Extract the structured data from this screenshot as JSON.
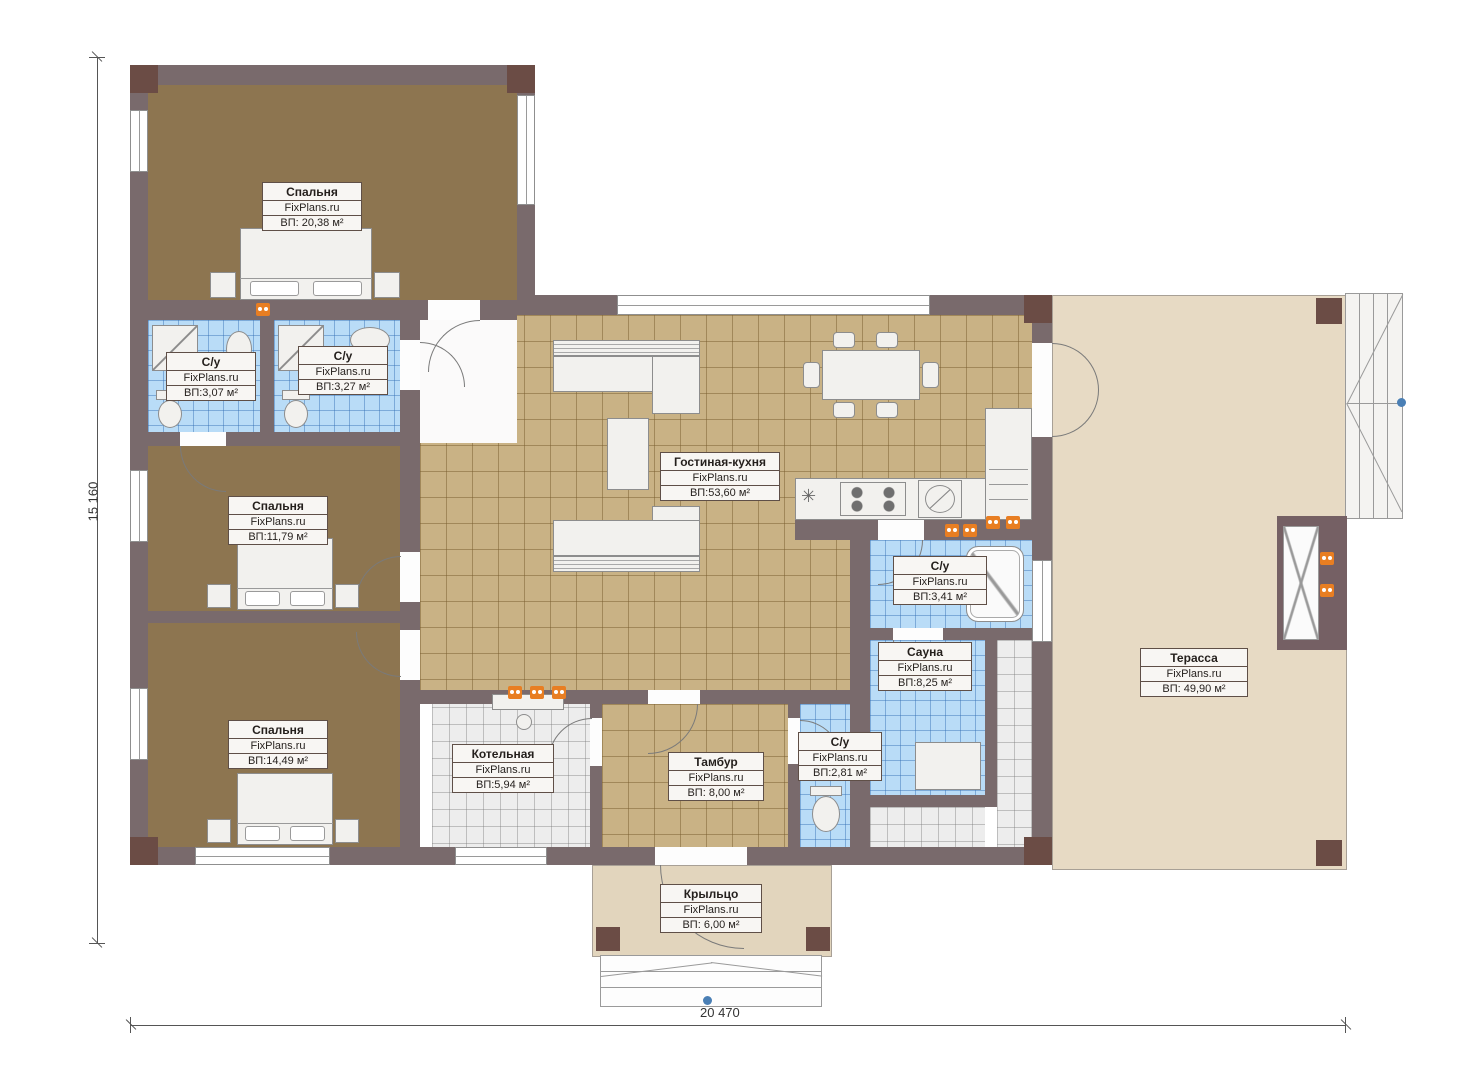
{
  "plan": {
    "height_label": "15 160",
    "width_label": "20 470"
  },
  "rooms": {
    "bedroom_top": {
      "name": "Спальня",
      "brand": "FixPlans.ru",
      "area": "ВП: 20,38 м²"
    },
    "bath_1": {
      "name": "С/у",
      "brand": "FixPlans.ru",
      "area": "ВП:3,07 м²"
    },
    "bath_2": {
      "name": "С/у",
      "brand": "FixPlans.ru",
      "area": "ВП:3,27 м²"
    },
    "bedroom_mid": {
      "name": "Спальня",
      "brand": "FixPlans.ru",
      "area": "ВП:11,79 м²"
    },
    "bedroom_low": {
      "name": "Спальня",
      "brand": "FixPlans.ru",
      "area": "ВП:14,49 м²"
    },
    "living": {
      "name": "Гостиная-кухня",
      "brand": "FixPlans.ru",
      "area": "ВП:53,60 м²"
    },
    "bath_3": {
      "name": "С/у",
      "brand": "FixPlans.ru",
      "area": "ВП:3,41 м²"
    },
    "sauna": {
      "name": "Сауна",
      "brand": "FixPlans.ru",
      "area": "ВП:8,25 м²"
    },
    "boiler": {
      "name": "Котельная",
      "brand": "FixPlans.ru",
      "area": "ВП:5,94 м²"
    },
    "vestibule": {
      "name": "Тамбур",
      "brand": "FixPlans.ru",
      "area": "ВП: 8,00 м²"
    },
    "bath_4": {
      "name": "С/у",
      "brand": "FixPlans.ru",
      "area": "ВП:2,81 м²"
    },
    "terrace": {
      "name": "Терасса",
      "brand": "FixPlans.ru",
      "area": "ВП: 49,90 м²"
    },
    "porch": {
      "name": "Крыльцо",
      "brand": "FixPlans.ru",
      "area": "ВП: 6,00 м²"
    }
  },
  "icons": {
    "hob_vent": "✳"
  },
  "colors": {
    "wall": "#796a6c",
    "wall_dark": "#6b4c45",
    "floor_bedroom": "#8d7550",
    "floor_living": "#c9b285",
    "floor_terrace": "#e7dac4",
    "tile_bath": "#b9dcf7",
    "tile_utility": "#ededed",
    "outlet": "#e87e22",
    "marker": "#4a7fb5"
  }
}
